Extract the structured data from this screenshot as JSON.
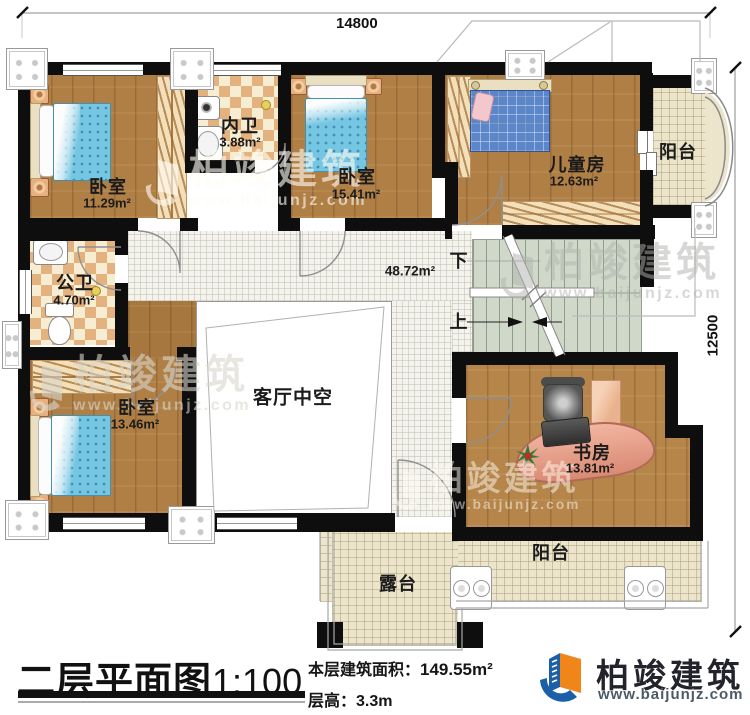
{
  "dimensions": {
    "top": "14800",
    "right": "12500"
  },
  "rooms": {
    "bedroom1": {
      "label": "卧室",
      "area": "11.29m²"
    },
    "inner_bath": {
      "label": "内卫",
      "area": "3.88m²"
    },
    "bedroom2": {
      "label": "卧室",
      "area": "15.41m²"
    },
    "kids_room": {
      "label": "儿童房",
      "area": "12.63m²"
    },
    "balcony_right": {
      "label": "阳台"
    },
    "public_bath": {
      "label": "公卫",
      "area": "4.70m²"
    },
    "bedroom3": {
      "label": "卧室",
      "area": "13.46m²"
    },
    "living_void": {
      "label": "客厅中空"
    },
    "hall": {
      "area": "48.72m²"
    },
    "study": {
      "label": "书房",
      "area": "13.81m²"
    },
    "balcony_bottom": {
      "label": "阳台"
    },
    "terrace": {
      "label": "露台"
    }
  },
  "stairs": {
    "down": "下",
    "up": "上"
  },
  "title": {
    "name": "二层平面图",
    "scale": "1:100"
  },
  "info": {
    "floor_area_label": "本层建筑面积：",
    "floor_area_value": "149.55m²",
    "floor_height": "层高：3.3m"
  },
  "brand": {
    "name": "柏竣建筑",
    "website": "www.baijunjz.com"
  },
  "watermark": {
    "name": "柏竣建筑",
    "website": "www.baijunjz.com"
  },
  "colors": {
    "wall": "#0e0e0e",
    "wood": "#b07f46",
    "tile": "#ece4cb",
    "checker": "#e3b27f",
    "stairs": "#cfd8c9",
    "brand_blue": "#1a5fa8",
    "brand_orange": "#f08519"
  }
}
